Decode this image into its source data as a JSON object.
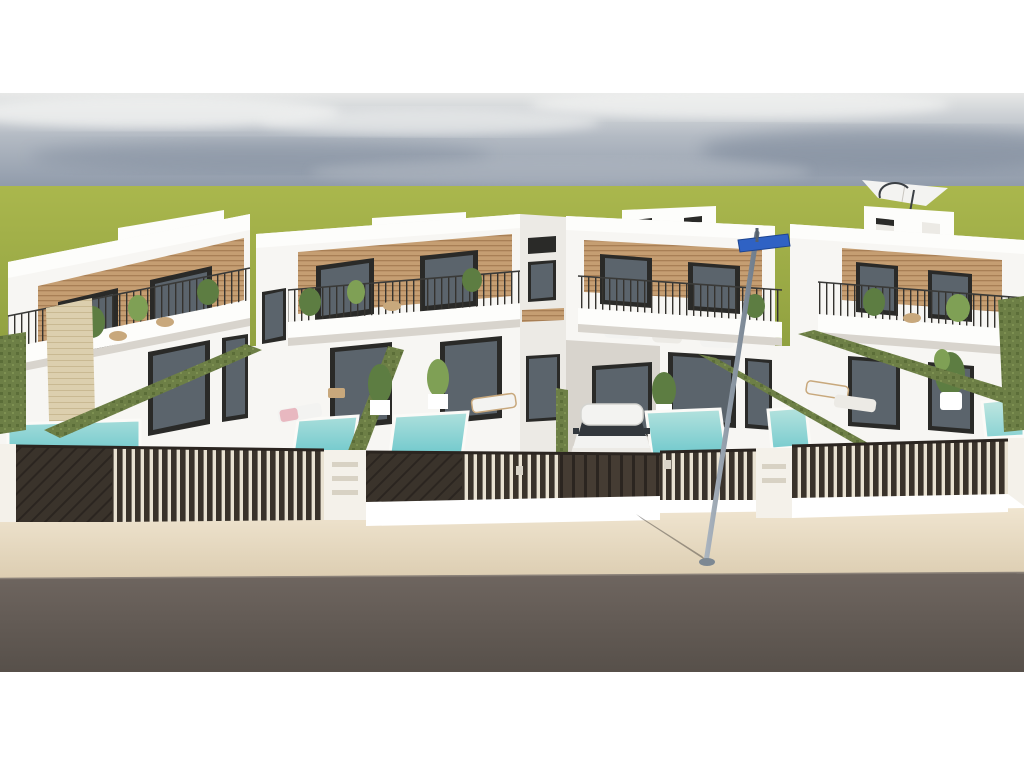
{
  "image": {
    "kind": "architectural-3d-render",
    "subject": "Row of modern white two-storey townhouses, each with rooftop terrace, wood-slat cladding, balcony, private pool and dark slatted street fence",
    "foreground": "beige sidewalk and grey asphalt road",
    "background": "flat green field under an overcast grey-blue sky",
    "letterbox": "white bars above and below the photo area"
  },
  "scene": {
    "house_blocks": 4,
    "rooftop_terraces": 4,
    "rooftop_umbrella": {
      "present": true,
      "color": "white",
      "position": "rightmost rooftop terrace"
    },
    "pools_visible": 6,
    "pool_style": "small rectangular, turquoise water, white coping",
    "hedge_walls": "artificial-grass covered dividing walls running diagonally",
    "vehicle": {
      "type": "white SUV",
      "position": "center driveway behind gate"
    },
    "street_lamp": {
      "present": true,
      "leaning": true,
      "sign": "small blue street sign at top"
    },
    "fence": "dark brown vertical-slat panels with white pillars and letterbox columns",
    "loungers": "white/tan sun loungers beside pools, one with pink towel",
    "plants": "potted green plants on balconies, terraces and yards"
  },
  "palette": {
    "sky_top": "#e7e8e7",
    "sky_mid": "#b3bac3",
    "sky_low": "#8e99a9",
    "cloud_light": "#f1f2f1",
    "cloud_dark": "#6e7b8f",
    "grass_light": "#aab74d",
    "grass_dark": "#7e9137",
    "wall_white": "#f7f6f3",
    "wall_bright": "#fdfdfb",
    "wall_shade": "#eceae5",
    "under_shadow": "#d8d4cd",
    "wood": "#c59e72",
    "wood_line": "#a87f55",
    "frame_dark": "#2a2a28",
    "glass": "#5b646c",
    "glass_light": "#99a5ad",
    "stone": "#dccfae",
    "stone_line": "#c9b992",
    "hedge": "#6d7f46",
    "hedge_dark": "#5b6d38",
    "hedge_light": "#7e9152",
    "pool_light": "#b9e4df",
    "pool_deep": "#54bec5",
    "fence_dark": "#3a332b",
    "fence_gap": "#e9e2d2",
    "fence_solid": "#453c33",
    "fence_rib": "#2b2520",
    "pillar_white": "#f4f1ea",
    "walk_light": "#efe4cf",
    "walk_dark": "#dccdb1",
    "road_light": "#6f6660",
    "road_dark": "#57504a",
    "pole_light": "#aab4bf",
    "pole_dark": "#6f7c8a",
    "sign_blue": "#2f62c4",
    "car_white": "#f3f3f1",
    "car_glass": "#33383d",
    "towel_pink": "#e8b8c0",
    "tan": "#c8a87c",
    "plant_green": "#5d7d42",
    "plant_light": "#7fa055"
  }
}
